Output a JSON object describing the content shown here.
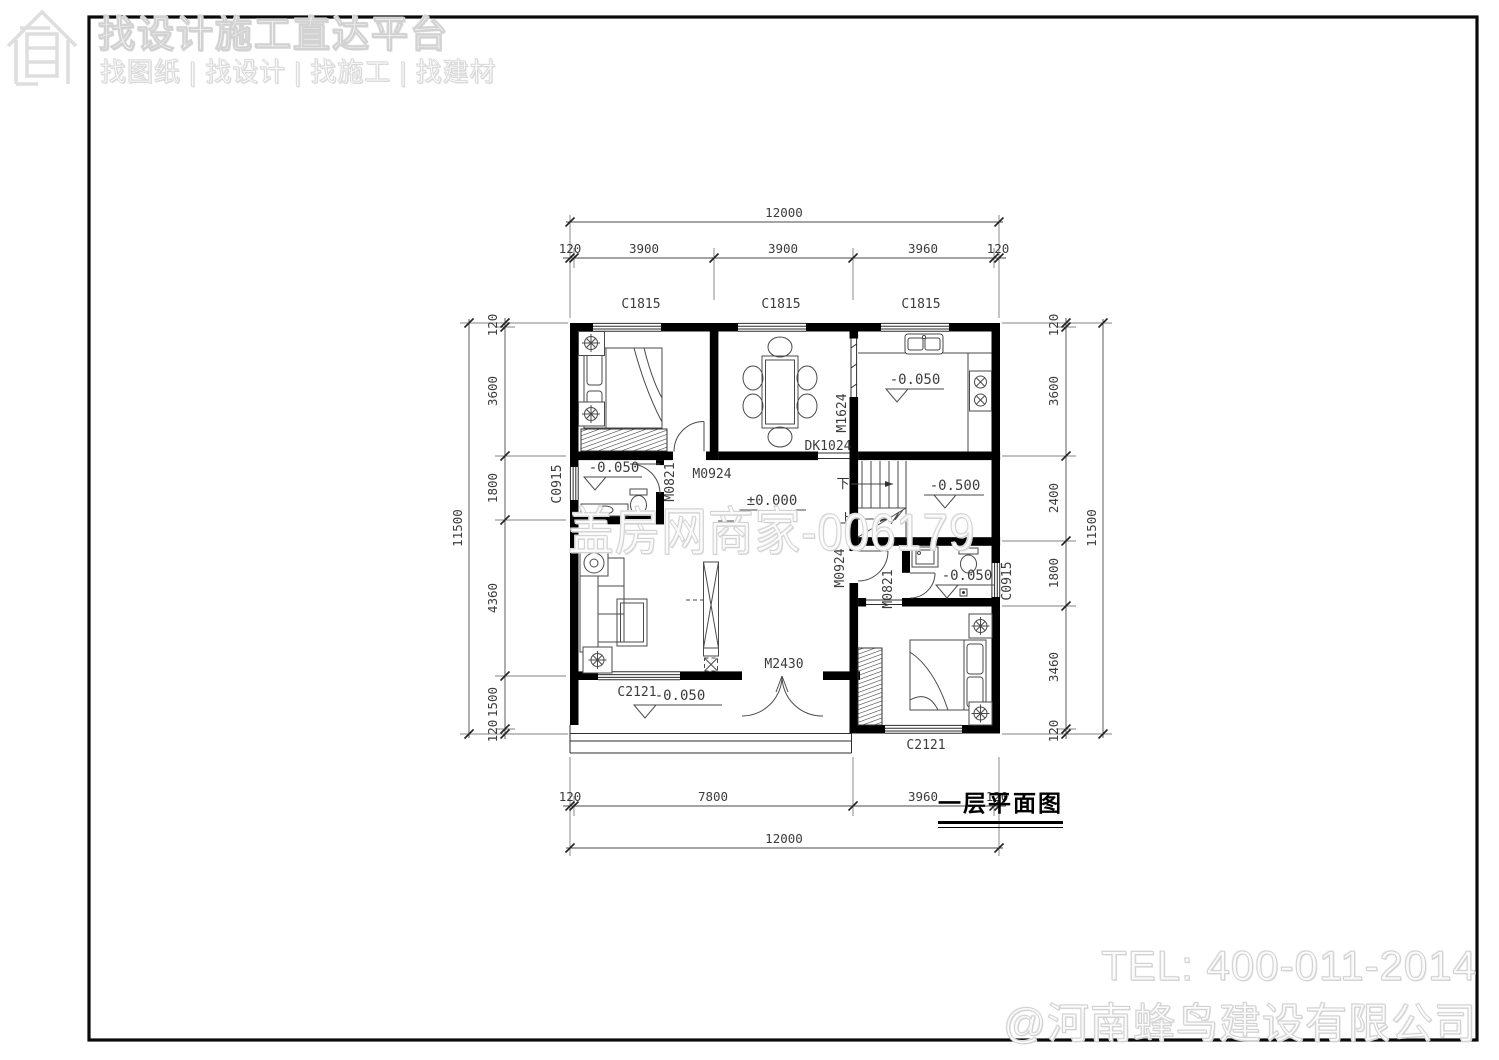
{
  "header": {
    "title": "找设计施工直达平台",
    "subtitle": "找图纸 | 找设计 | 找施工 | 找建材"
  },
  "watermarks": {
    "center": "盖房网商家-006179",
    "tel": "TEL: 400-011-2014",
    "company": "@河南蜂鸟建设有限公司"
  },
  "plan": {
    "title": "一层平面图",
    "levels": {
      "kitchen": "-0.050",
      "bath_left": "-0.050",
      "bath_right": "-0.050",
      "living": "±0.000",
      "stair": "-0.500",
      "porch": "-0.050"
    },
    "stair": {
      "down": "下",
      "up": "上"
    },
    "windows": {
      "c1815": "C1815",
      "c0915": "C0915",
      "c2121": "C2121"
    },
    "doors": {
      "m0924": "M0924",
      "m0821": "M0821",
      "m1624": "M1624",
      "m2430": "M2430",
      "dk1024": "DK1024"
    },
    "dims": {
      "top": {
        "overall": "12000",
        "segs": [
          "120",
          "3900",
          "3900",
          "3960",
          "120"
        ]
      },
      "bottom": {
        "overall": "12000",
        "segs": [
          "120",
          "7800",
          "3960",
          "120"
        ]
      },
      "left": {
        "overall": "11500",
        "segs": [
          "120",
          "3600",
          "1800",
          "4360",
          "1500",
          "120"
        ]
      },
      "right": {
        "overall": "11500",
        "segs": [
          "120",
          "3600",
          "2400",
          "1800",
          "3460",
          "120"
        ]
      }
    }
  }
}
